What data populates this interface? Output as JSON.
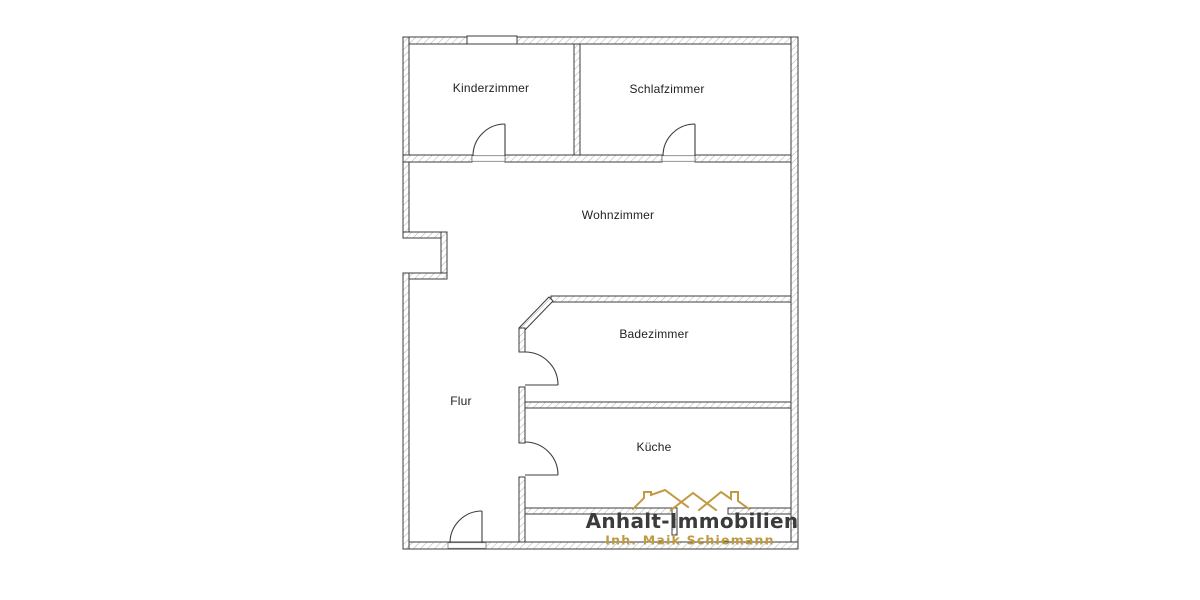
{
  "plan": {
    "type": "floor-plan",
    "rooms": [
      {
        "id": "kinderzimmer",
        "label": "Kinderzimmer"
      },
      {
        "id": "schlafzimmer",
        "label": "Schlafzimmer"
      },
      {
        "id": "wohnzimmer",
        "label": "Wohnzimmer"
      },
      {
        "id": "badezimmer",
        "label": "Badezimmer"
      },
      {
        "id": "flur",
        "label": "Flur"
      },
      {
        "id": "kueche",
        "label": "Küche"
      }
    ],
    "features": {
      "windows": [
        "top-wall-window"
      ],
      "doors": [
        "kinderzimmer-door",
        "schlafzimmer-door",
        "badezimmer-door",
        "kueche-door",
        "entrance-door",
        "balcony-opening"
      ]
    }
  },
  "logo": {
    "title": "Anhalt-Immobilien",
    "subtitle": "Inh. Maik Schiemann",
    "icon": "rooftops-icon",
    "colors": {
      "gold": "#c29a42",
      "title_text": "#3b3b3b"
    }
  },
  "colors": {
    "wall_line": "#3d3d3d",
    "wall_hatch": "#b5b5b5",
    "label_text": "#222222",
    "background": "#ffffff"
  }
}
